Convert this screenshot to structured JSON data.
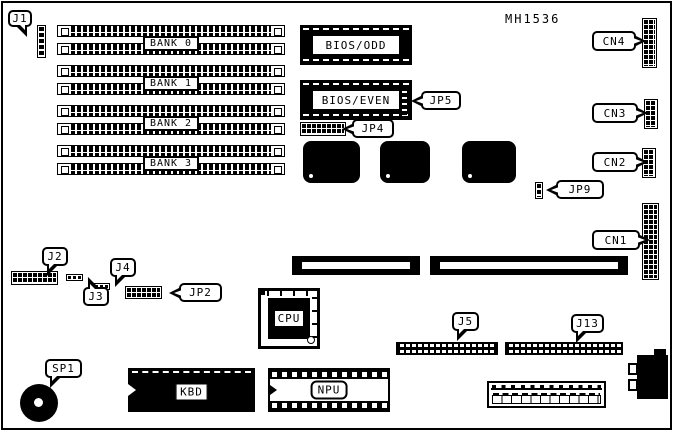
{
  "diagram": {
    "part_number": "MH1536",
    "type": "motherboard-layout"
  },
  "colors": {
    "background": "#ffffff",
    "line": "#000000"
  },
  "labels": {
    "j1": "J1",
    "j2": "J2",
    "j3": "J3",
    "j4": "J4",
    "j5": "J5",
    "j13": "J13",
    "jp2": "JP2",
    "jp4": "JP4",
    "jp5": "JP5",
    "jp9": "JP9",
    "cn1": "CN1",
    "cn2": "CN2",
    "cn3": "CN3",
    "cn4": "CN4",
    "sp1": "SP1",
    "bank0": "BANK 0",
    "bank1": "BANK 1",
    "bank2": "BANK 2",
    "bank3": "BANK 3",
    "bios_odd": "BIOS/ODD",
    "bios_even": "BIOS/EVEN",
    "cpu": "CPU",
    "kbd": "KBD",
    "npu": "NPU"
  }
}
